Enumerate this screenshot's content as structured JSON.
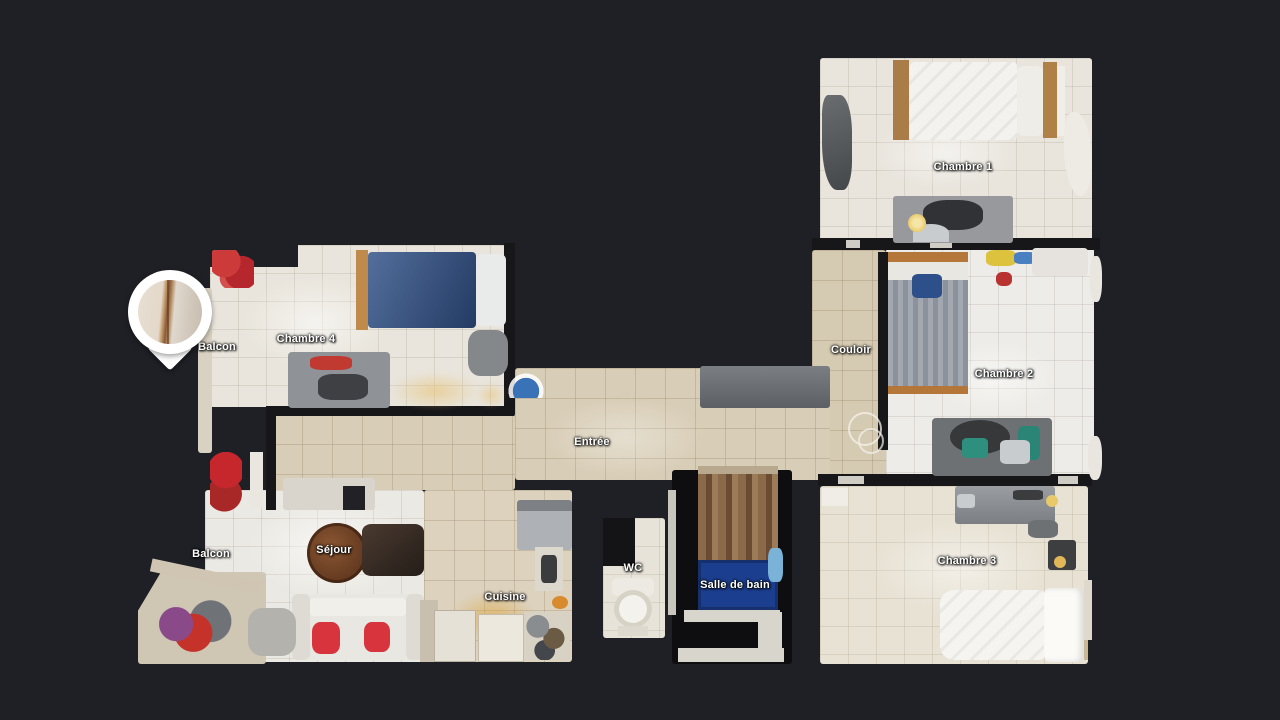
{
  "view": {
    "kind": "apartment-floorplan-top-view",
    "background": "#1f2026"
  },
  "rooms": [
    {
      "id": "chambre-1",
      "label": "Chambre 1"
    },
    {
      "id": "chambre-2",
      "label": "Chambre 2"
    },
    {
      "id": "chambre-3",
      "label": "Chambre 3"
    },
    {
      "id": "chambre-4",
      "label": "Chambre 4"
    },
    {
      "id": "couloir",
      "label": "Couloir"
    },
    {
      "id": "entree",
      "label": "Entrée"
    },
    {
      "id": "sejour",
      "label": "Séjour"
    },
    {
      "id": "cuisine",
      "label": "Cuisine"
    },
    {
      "id": "wc",
      "label": "WC"
    },
    {
      "id": "salle-de-bain",
      "label": "Salle de bain"
    },
    {
      "id": "balcon-haut",
      "label": "Balcon"
    },
    {
      "id": "balcon-bas",
      "label": "Balcon"
    }
  ],
  "marker": {
    "name": "photo-pin-marker",
    "shape": "teardrop",
    "preview": "wall-with-wood-trim"
  },
  "colors": {
    "background": "#1f2026",
    "wall": "#17171a",
    "label_text": "#ffffff",
    "pin": "#ffffff",
    "floor_beige": "#d8cdb6",
    "floor_light": "#ebe9e3",
    "bed_blue": "#2e4f86",
    "bath_mat_blue": "#1c3e8e",
    "accent_red": "#c5272d"
  }
}
